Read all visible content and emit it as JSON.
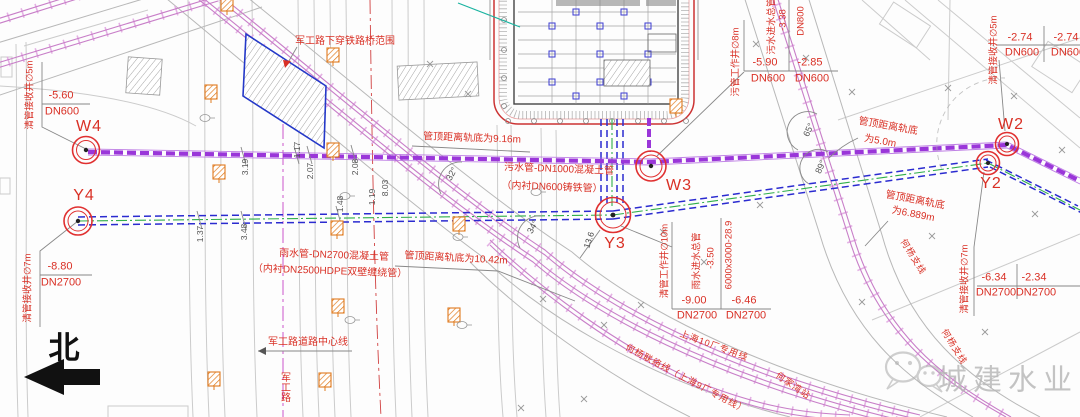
{
  "page": {
    "kind": "municipal pipeline railway-crossing plan drawing"
  },
  "north": {
    "label": "北"
  },
  "watermark": {
    "text": "城建水业"
  },
  "manholes": {
    "w4": {
      "id": "W4",
      "note": "清管接收井∅5m",
      "frac": [
        {
          "elev": "-5.60",
          "dn": "DN600"
        }
      ]
    },
    "y4": {
      "id": "Y4",
      "note": "清管接收井∅7m",
      "frac": [
        {
          "elev": "-8.80",
          "dn": "DN2700"
        }
      ]
    },
    "w3": {
      "id": "W3",
      "note": "污管工作井∅8m",
      "inlet": {
        "name": "污水进水总管",
        "elev": "-3.38",
        "dn": "DN800"
      },
      "frac": [
        {
          "elev": "-5.90",
          "dn": "DN600"
        },
        {
          "elev": "-2.85",
          "dn": "DN600"
        }
      ]
    },
    "y3": {
      "id": "Y3",
      "note": "清管工作井∅10m",
      "inlet": {
        "name": "雨水进水总管",
        "elev": "-3.50",
        "size": "6000x3000-28.9"
      },
      "frac": [
        {
          "elev": "-9.00",
          "dn": "DN2700"
        },
        {
          "elev": "-6.46",
          "dn": "DN2700"
        }
      ]
    },
    "w2": {
      "id": "W2",
      "note": "清管接收井∅5m",
      "frac": [
        {
          "elev": "-2.74",
          "dn": "DN600"
        },
        {
          "elev": "-2.74",
          "dn": "DN600"
        }
      ]
    },
    "y2": {
      "id": "Y2",
      "note": "清管接收井∅7m",
      "frac": [
        {
          "elev": "-6.34",
          "dn": "DN2700"
        },
        {
          "elev": "-2.34",
          "dn": "DN2700"
        }
      ]
    }
  },
  "pipes": {
    "sewage_label_1": "污水管-DN1000混凝土管",
    "sewage_label_2": "（内衬DN600铸铁管）",
    "rain_label_1": "雨水管-DN2700混凝土管",
    "rain_label_2": "（内衬DN2500HDPE双壁缠绕管）"
  },
  "clearances": {
    "sewage_rail": "管顶距离轨底为9.16m",
    "rain_rail": "管顶距离轨底为10.42m",
    "east_sewage_1": "管顶距离轨底",
    "east_sewage_2": "为5.0m",
    "east_rain_1": "管顶距离轨底",
    "east_rain_2": "为6.889m"
  },
  "roads": {
    "underpass_zone": "军工路下穿铁路桥范围",
    "centerline": "军工路道路中心线",
    "road_name": "军工路"
  },
  "railways": {
    "line10": "上海10厂专用线",
    "line9": "何杨联络线（上海9厂专用线）",
    "station": "何家湾站",
    "branch": "何杨支线"
  },
  "dimensions": [
    "3.19",
    "2.07",
    "2.08",
    "1.17",
    "3.48",
    "1.37",
    "1.48",
    "1.19",
    "8.03",
    "13.6"
  ],
  "angles": [
    "32°",
    "34°",
    "65°",
    "89°"
  ],
  "colors": {
    "annotation_red": "#d93025",
    "sewage_purple": "#9a36d9",
    "rain_blue": "#2b2bd0",
    "centerline_green": "#2fae4a",
    "railway_pink": "#d88ad8",
    "road_gray": "#bdbdbd",
    "boundary_blue": "#2438c8"
  }
}
